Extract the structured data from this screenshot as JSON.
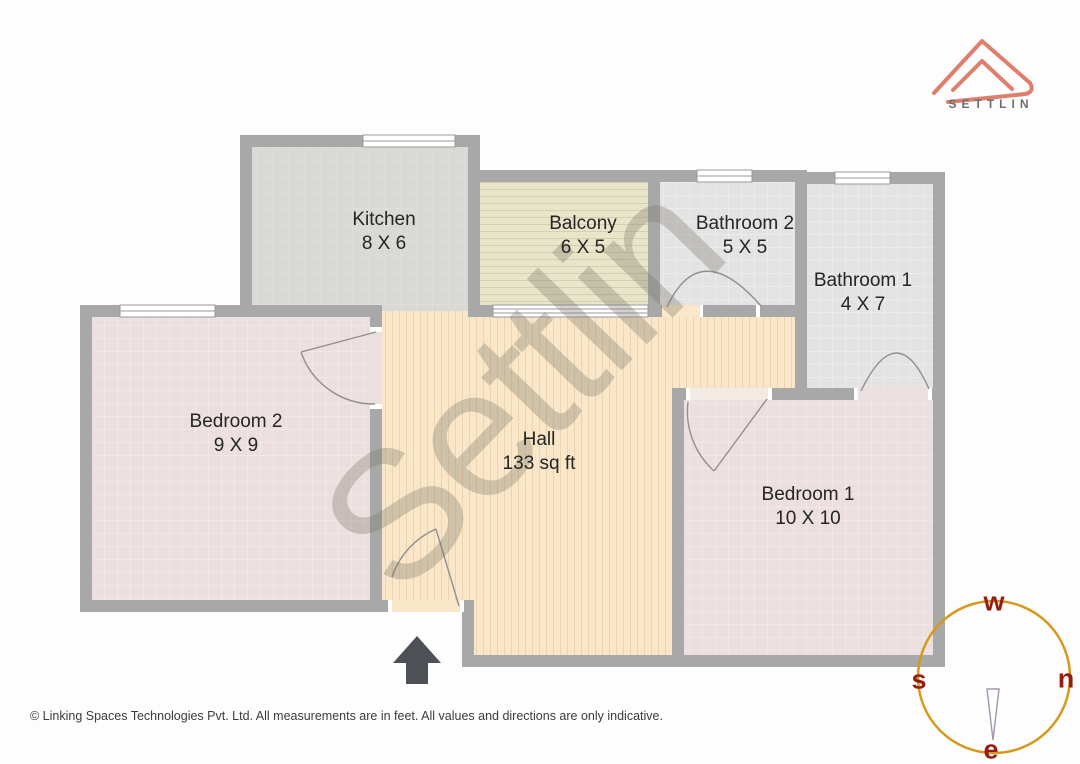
{
  "header": {
    "brand_name": "SETTLIN"
  },
  "watermark": {
    "text": "Settlin"
  },
  "plan": {
    "rooms": [
      {
        "name": "Kitchen",
        "dims": "8 X 6"
      },
      {
        "name": "Balcony",
        "dims": "6 X 5"
      },
      {
        "name": "Bathroom 2",
        "dims": "5 X 5"
      },
      {
        "name": "Bathroom 1",
        "dims": "4 X 7"
      },
      {
        "name": "Bedroom 2",
        "dims": "9 X 9"
      },
      {
        "name": "Hall",
        "dims": "133 sq ft"
      },
      {
        "name": "Bedroom 1",
        "dims": "10 X 10"
      }
    ]
  },
  "compass": {
    "top": "w",
    "left": "s",
    "right": "n",
    "bottom": "e"
  },
  "footer": {
    "text": "© Linking Spaces Technologies Pvt. Ltd. All measurements are in feet. All values and directions are only indicative."
  },
  "colors": {
    "brand_logo": "#e07e6e",
    "compass_ring": "#d6991c",
    "compass_labels": "#961c0e",
    "walls": "#a8a8a8",
    "hall_floor": "#fae6c8",
    "bedroom_floor": "#ecdfdf",
    "kitchen_floor": "#d9dad5",
    "balcony_floor": "#e9e5ca",
    "bathroom_floor": "#e3e3e3",
    "entry_arrow": "#4d5156"
  }
}
